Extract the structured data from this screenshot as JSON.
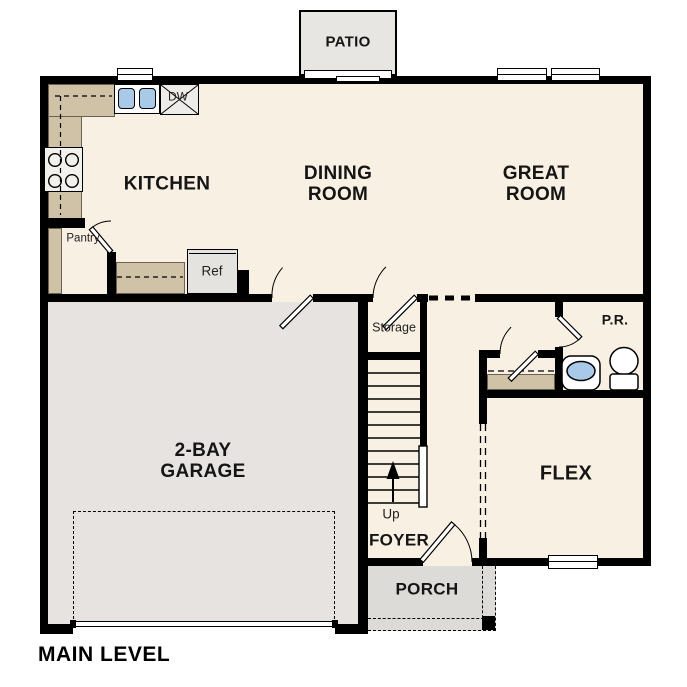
{
  "title": "MAIN LEVEL",
  "colors": {
    "floor": "#f8f0e2",
    "garage_floor": "#e6e3e0",
    "patio": "#e8e6e2",
    "porch": "#dddbd7",
    "counter": "#cfc2a6",
    "appliance": "#e4e3df",
    "fixture_blue": "#a9c9e9",
    "wall": "#000000"
  },
  "rooms": {
    "kitchen": {
      "label": "KITCHEN"
    },
    "dining": {
      "line1": "DINING",
      "line2": "ROOM"
    },
    "great": {
      "line1": "GREAT",
      "line2": "ROOM"
    },
    "garage": {
      "line1": "2-BAY",
      "line2": "GARAGE"
    },
    "flex": {
      "label": "FLEX"
    },
    "foyer": {
      "label": "FOYER"
    },
    "porch": {
      "label": "PORCH"
    },
    "patio": {
      "label": "PATIO"
    },
    "powder_room": {
      "label": "P.R."
    },
    "storage": {
      "label": "Storage"
    },
    "pantry": {
      "label": "Pantry"
    }
  },
  "fixtures": {
    "dishwasher": "DW",
    "refrigerator": "Ref",
    "stairs_direction": "Up"
  }
}
